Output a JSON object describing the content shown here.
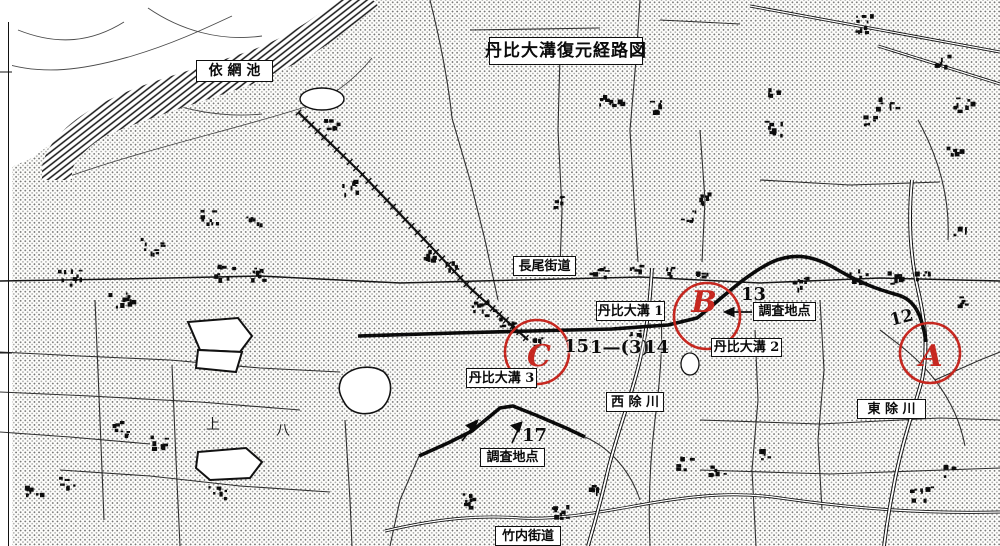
{
  "map": {
    "title": {
      "text": "丹比大溝復元経路図"
    },
    "boxed_labels": [
      {
        "id": "yosami-pond",
        "text": "依 網 池"
      },
      {
        "id": "nagao-kaido",
        "text": "長尾街道"
      },
      {
        "id": "tajihi-omizo-1",
        "text": "丹比大溝 1"
      },
      {
        "id": "survey-point-east",
        "text": "調査地点"
      },
      {
        "id": "tajihi-omizo-2",
        "text": "丹比大溝 2"
      },
      {
        "id": "tajihi-omizo-3",
        "text": "丹比大溝 3"
      },
      {
        "id": "nishi-yoke-river",
        "text": "西 除 川"
      },
      {
        "id": "survey-point-south",
        "text": "調査地点"
      },
      {
        "id": "takenouchi-kaido",
        "text": "竹内街道"
      },
      {
        "id": "higashi-yoke-river",
        "text": "東 除 川"
      }
    ],
    "point_numbers": [
      {
        "id": "point-13",
        "text": "13"
      },
      {
        "id": "point-15",
        "text": "15"
      },
      {
        "id": "point-1-3",
        "text": "1—(3)"
      },
      {
        "id": "point-14",
        "text": "14"
      },
      {
        "id": "point-17",
        "text": "17"
      },
      {
        "id": "point-12",
        "text": "12"
      }
    ],
    "markers": [
      {
        "id": "circle-a",
        "letter": "A"
      },
      {
        "id": "circle-b",
        "letter": "B"
      },
      {
        "id": "circle-c",
        "letter": "C"
      }
    ],
    "base_labels": [
      {
        "text": "上"
      },
      {
        "text": "八"
      }
    ],
    "colors": {
      "annotation_red": "#c62820",
      "ink": "#141414",
      "paper": "#fdfdfb"
    }
  }
}
